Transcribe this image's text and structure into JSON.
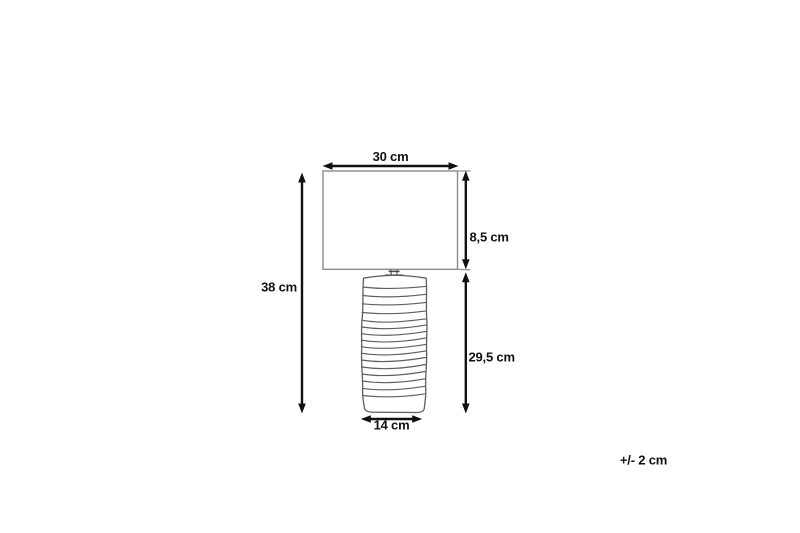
{
  "meta": {
    "background_color": "#ffffff",
    "dimension_line_color": "#111111",
    "sketch_line_color": "#8c8c8c"
  },
  "diagram": {
    "subject": "table-lamp-dimension-drawing",
    "parts": {
      "shade": "rectangular lamp shade",
      "base": "ribbed cylindrical lamp base"
    },
    "labels": {
      "shade_width": "30 cm",
      "shade_height": "8,5 cm",
      "total_height": "38 cm",
      "base_height": "29,5 cm",
      "base_width": "14 cm",
      "tolerance": "+/- 2 cm"
    }
  }
}
